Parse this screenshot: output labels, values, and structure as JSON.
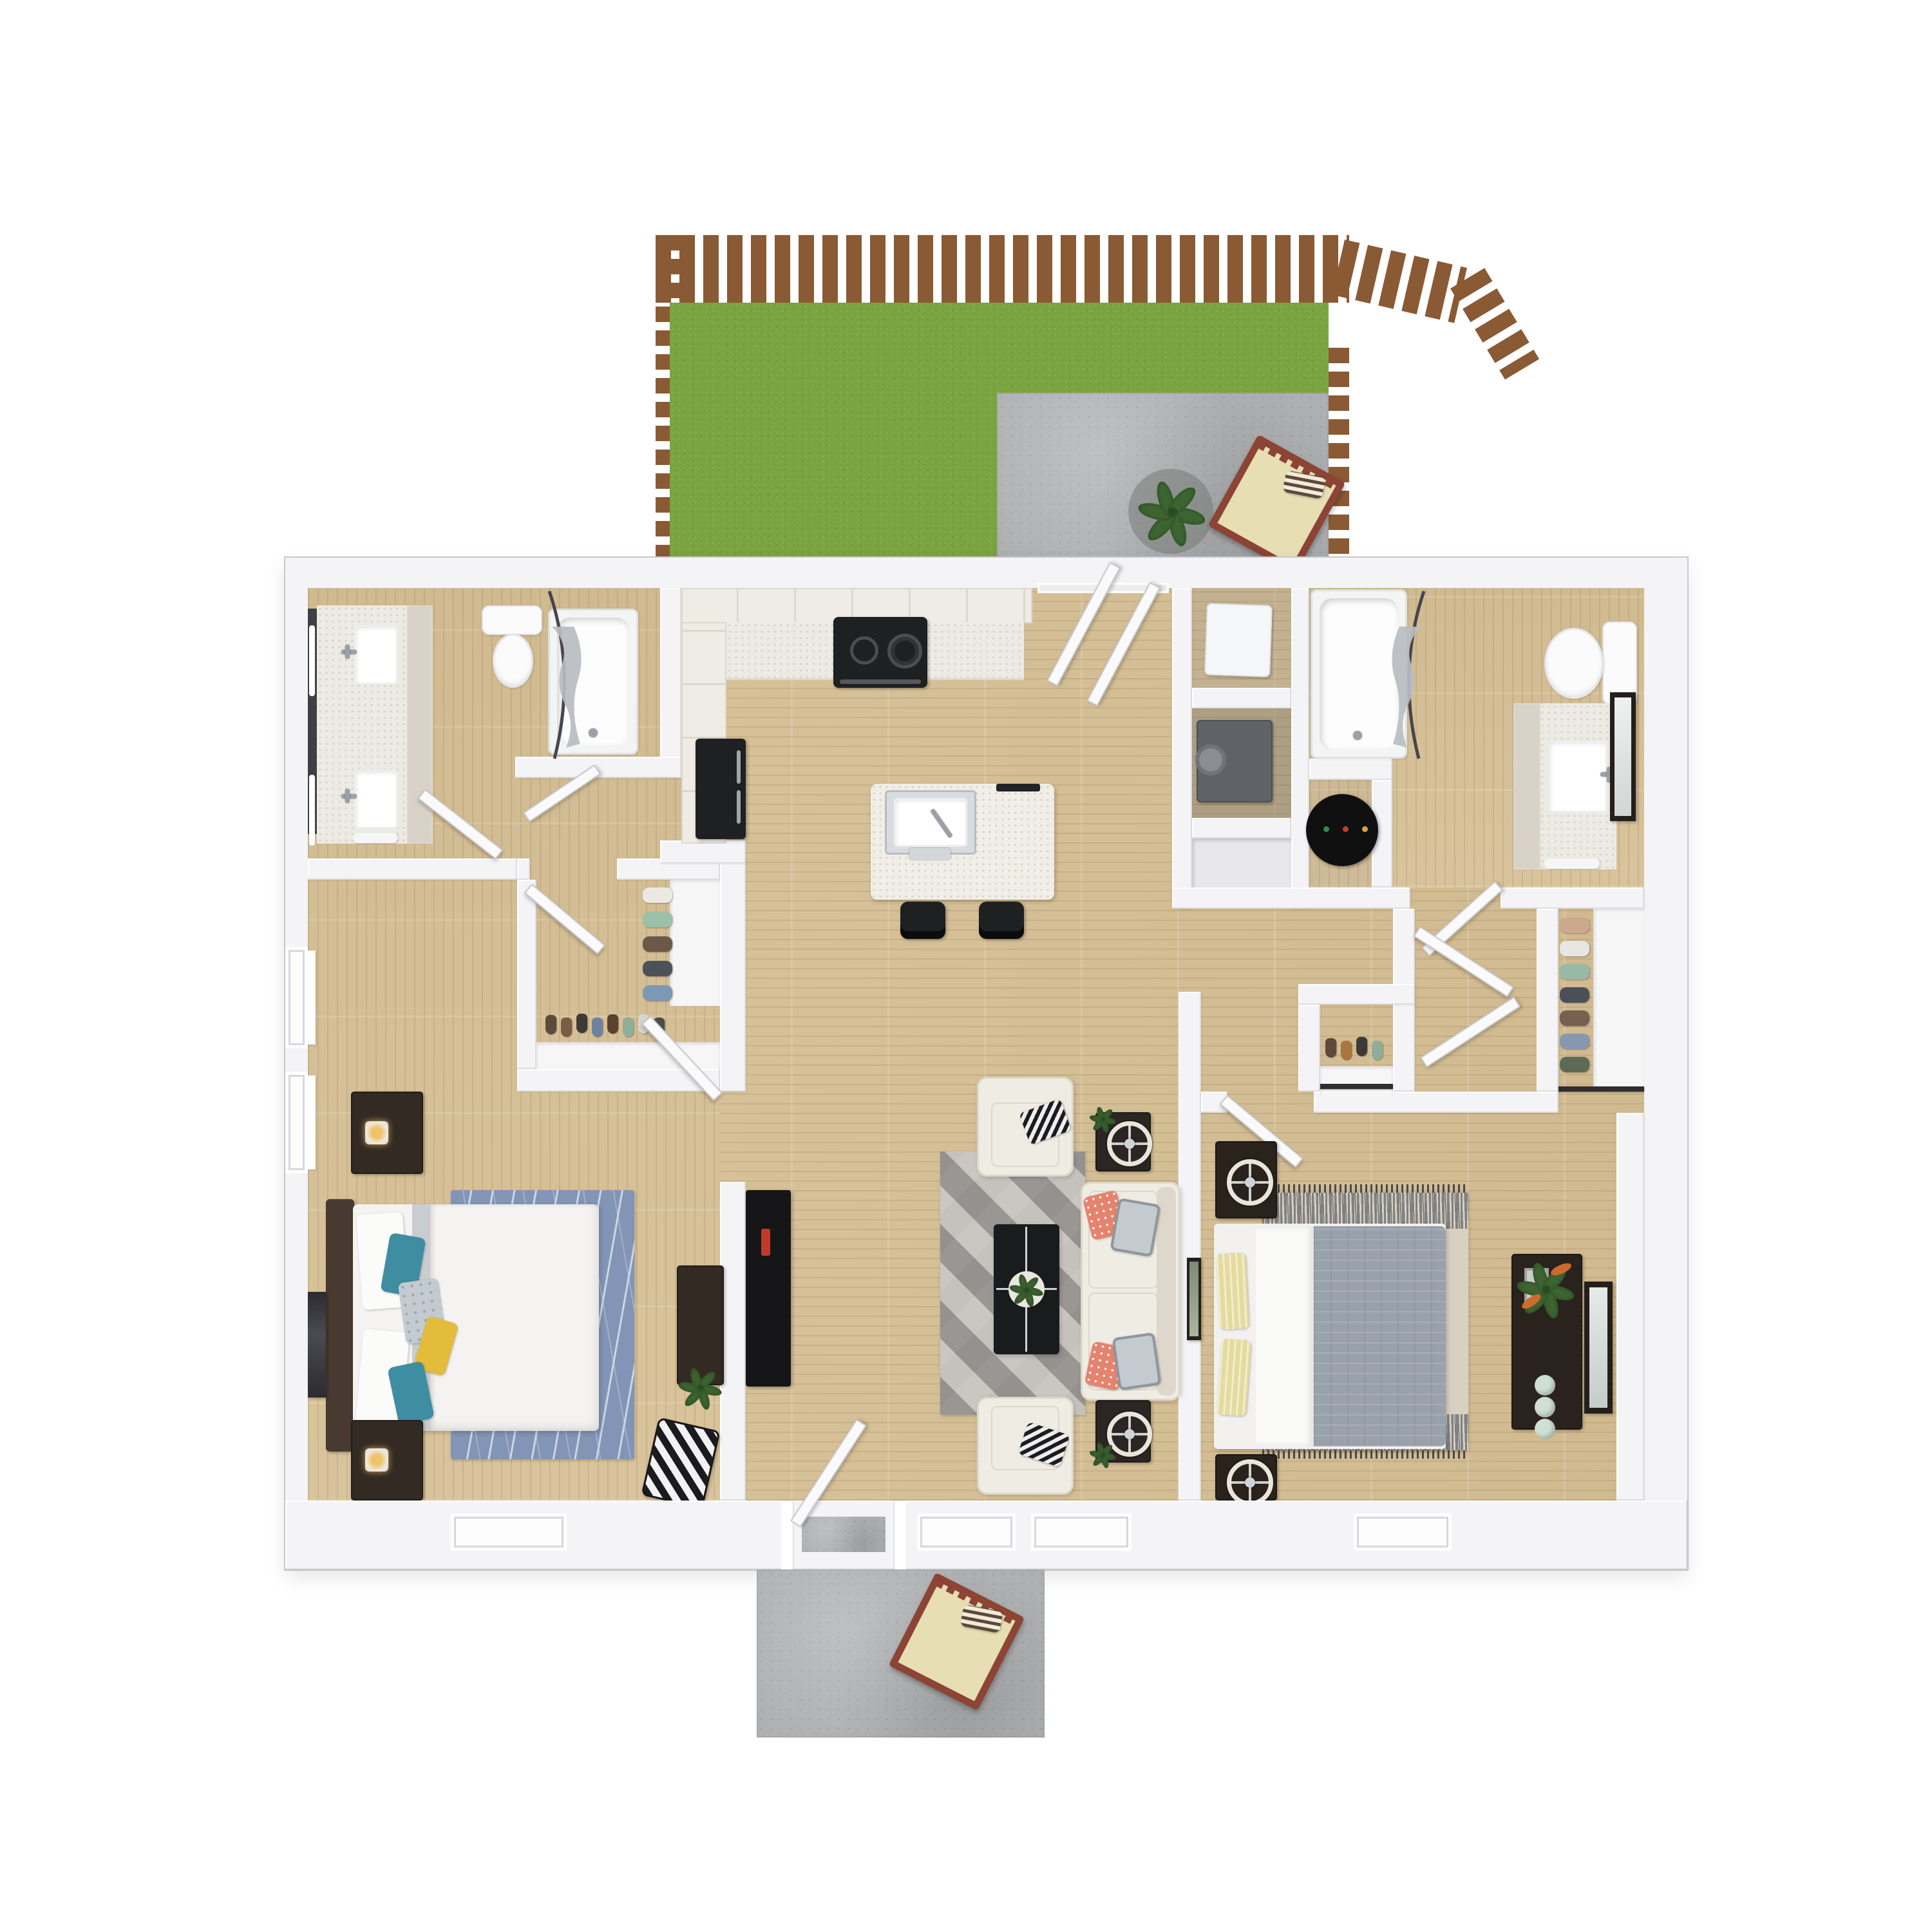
{
  "meta": {
    "type": "floor-plan-3d-render",
    "view": "top-down dollhouse",
    "description": "3D rendered floor plan of a two-bedroom, two-bathroom apartment with a private fenced back yard with concrete patio, open kitchen with island, living room, walk-in closets, laundry closet, water-heater closet and front entry porch",
    "text_on_screen": "none"
  },
  "colors": {
    "page": "#ffffff",
    "wall": "#f4f4f6",
    "wallShade": "#dededf",
    "wood": "#d6c096",
    "grass": "#7aa43f",
    "fence": "#8a5a35",
    "fenceDark": "#704628",
    "concrete": "#aeb0b2",
    "concreteDot": "#9a9c9e",
    "discShadow": "#70757280",
    "plantGreen": "#3d6531",
    "plantDark": "#2c4a22",
    "chairFrame": "#8c4434",
    "chairCushion": "#e7deb3",
    "counter": "#eceae2",
    "counterDot": "#d2cfc0",
    "cabinet": "#efece6",
    "cabinetLine": "#ddd8ce",
    "cabinetTaupe": "#d8d2c9",
    "appliance": "#1f2022",
    "stainless": "#c9ced2",
    "island": "#f0eee6",
    "washer": "#f5f6f7",
    "dryer": "#5f6367",
    "waterHeater": "#101011",
    "tub": "#f3f4f4",
    "porcelain": "#fbfbfc",
    "curtain": "#b9bdc2",
    "curtainRod": "#46464c",
    "mirror": "#3f3f46",
    "door": "#fafafb",
    "doorEdge": "#c9c9ce",
    "sofa": "#efece3",
    "sofaShade": "#ddd8cb",
    "rugLivLight": "#c8c5c1",
    "rugLivDark": "#8f8c89",
    "tableBlack": "#1a1b1d",
    "sideTable": "#2b2623",
    "ringLamp": "#e9e5da",
    "rugBed1": "#8395b6",
    "rugBed1Line": "#ccd5e3",
    "duvet": "#f4f3f1",
    "sheetBand": "#c9cdd1",
    "headboard": "#483931",
    "darkWood": "#322a23",
    "lampGlow": "#f0c26a",
    "pillowTeal": "#3e8da1",
    "pillowYellow": "#e3bc3c",
    "pillowGray": "#c3cad0",
    "pillowOrange": "#e5836e",
    "chevA": "#1b1b1e",
    "chevB": "#f2f2f2",
    "rugBed2": "#d8d1c2",
    "rugBed2Band": "#7d8184",
    "comforter": "#99a1ab",
    "pillowButter": "#e4db9e",
    "accentRed": "#c03a2b",
    "shelfWhite": "#f6f6f7"
  },
  "outdoor": {
    "yard": {
      "label": "fenced back yard",
      "items": [
        "wood-picket-fence",
        "open-gate",
        "lawn",
        "concrete-patio",
        "potted-plant",
        "wood-lounge-chair",
        "striped-pillow"
      ]
    },
    "porch": {
      "label": "front entry porch",
      "items": [
        "concrete-pad",
        "wood-lounge-chair",
        "striped-pillow"
      ]
    }
  },
  "rooms": [
    {
      "id": "bathroom-1",
      "label": "bathroom 1",
      "items": [
        "lit-mirror",
        "double-vanity",
        "two-sinks",
        "linen-cabinet",
        "toilet",
        "bathtub",
        "shower-curtain",
        "door"
      ]
    },
    {
      "id": "kitchen",
      "label": "kitchen",
      "items": [
        "upper-cabinets",
        "speckled-countertop",
        "range",
        "refrigerator",
        "pantry-cabinets",
        "island-with-sink",
        "faucet",
        "two-bar-stools",
        "open-double-doors-to-yard"
      ]
    },
    {
      "id": "laundry-closet",
      "label": "laundry closet",
      "items": [
        "washer",
        "dryer",
        "storage-niche"
      ]
    },
    {
      "id": "water-heater-closet",
      "label": "water-heater closet",
      "items": [
        "water-heater"
      ]
    },
    {
      "id": "bathroom-2",
      "label": "bathroom 2",
      "items": [
        "bathtub",
        "shower-curtain",
        "toilet",
        "vanity",
        "sink",
        "leaning-mirror",
        "door"
      ]
    },
    {
      "id": "walk-in-closet",
      "label": "walk-in closet",
      "items": [
        "hanging-clothes",
        "shoe-row",
        "low-shelf",
        "door"
      ]
    },
    {
      "id": "bedroom-1",
      "label": "bedroom 1",
      "items": [
        "queen-bed",
        "dark-headboard",
        "accent-pillows",
        "two-nightstands",
        "lit-lamps",
        "wavy-blue-rug",
        "dresser",
        "potted-plant",
        "wall-art",
        "chevron-floor-pillow",
        "two-side-windows",
        "rear-window",
        "door"
      ]
    },
    {
      "id": "living-room",
      "label": "living room",
      "items": [
        "tv-console",
        "geometric-gray-rug",
        "black-coffee-table",
        "centerpiece-plant",
        "white-sofa",
        "two-armchairs",
        "patterned-pillows",
        "two-side-tables",
        "round-lamps",
        "wall-art",
        "open-front-door",
        "two-rear-windows"
      ]
    },
    {
      "id": "hallway",
      "label": "hallway",
      "items": [
        "double-door-closet",
        "linen-closet-with-clothes",
        "shoe-closet"
      ]
    },
    {
      "id": "bedroom-2",
      "label": "bedroom 2",
      "items": [
        "queen-bed",
        "gray-comforter",
        "butter-yellow-pillows",
        "two-nightstands",
        "round-lamps",
        "bordered-beige-rug",
        "dresser",
        "potted-plant",
        "decor-jars",
        "leaning-mirror",
        "sliding-closet-rail",
        "rear-window",
        "door"
      ]
    }
  ]
}
